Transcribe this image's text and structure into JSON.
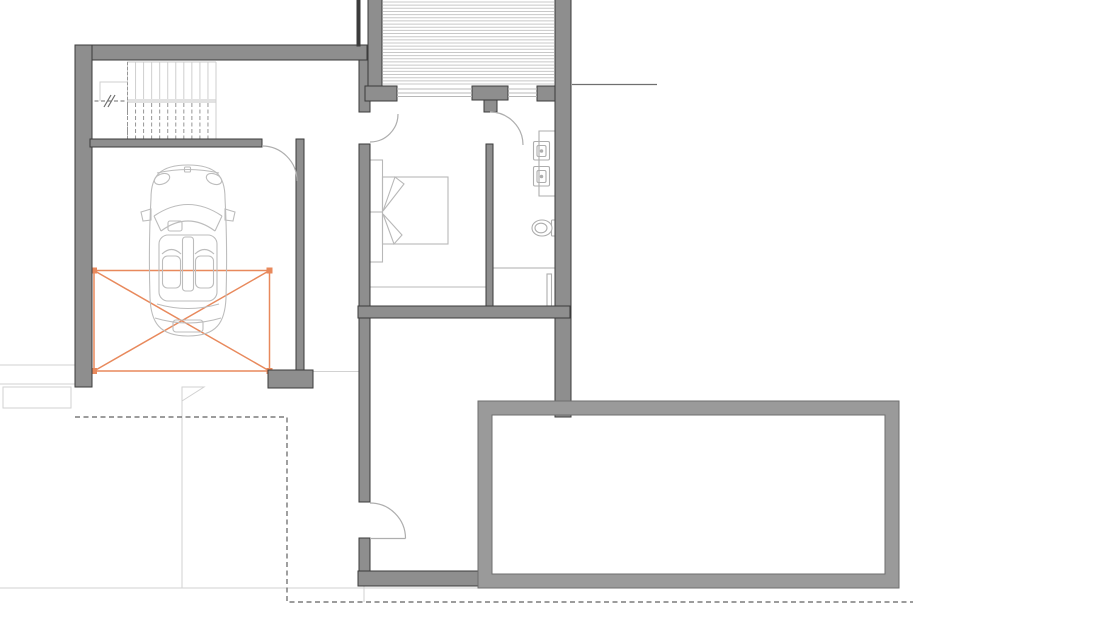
{
  "document": {
    "kind": "architectural-floor-plan",
    "title": "",
    "visible_text": [],
    "description": "CAD-style floor plan: garage with convertible car and orange cross parking/lift marker, staircase with direction line, hatched ramp, bedroom with double bed, bathroom with two basins, WC and shower, hallway with entry door, attached pool structure, dashed property boundary at lower left."
  },
  "palette": {
    "background": "#ffffff",
    "wall_fill": "#8e8e8e",
    "wall_outline": "#3b3b3b",
    "pool_wall_fill": "#9a9a9a",
    "pool_wall_outline": "#6e6e6e",
    "fixture_line": "#aeaeae",
    "furniture_line": "#b8b8b8",
    "car_line": "#bdbdbd",
    "hatch_line": "#c8c8c8",
    "stair_upper_line": "#cfcfcf",
    "stair_lower_line": "#969696",
    "stair_landing_fill": "#e2e2e2",
    "boundary_dash": "#606060",
    "reference_line": "#6f6f6f",
    "light_line": "#d2d2d2",
    "accent_orange": "#e8895c"
  },
  "plan": {
    "rooms": [
      {
        "name": "garage",
        "furnishings": [
          "car",
          "parking-lift-marker"
        ]
      },
      {
        "name": "staircase"
      },
      {
        "name": "ramp"
      },
      {
        "name": "corridor"
      },
      {
        "name": "bedroom",
        "furnishings": [
          "double-bed"
        ]
      },
      {
        "name": "bathroom",
        "furnishings": [
          "basin",
          "basin",
          "toilet",
          "shower"
        ]
      },
      {
        "name": "hall"
      },
      {
        "name": "pool"
      }
    ],
    "symbols": [
      "door-swing",
      "window",
      "property-boundary-dashed",
      "parking-cross-marker",
      "stair-direction-line",
      "boundary-flag-marker"
    ]
  },
  "stairs": {
    "upper_flight_steps": 12,
    "lower_flight_steps": 12
  },
  "ramp": {
    "hatch_lines": 27
  }
}
